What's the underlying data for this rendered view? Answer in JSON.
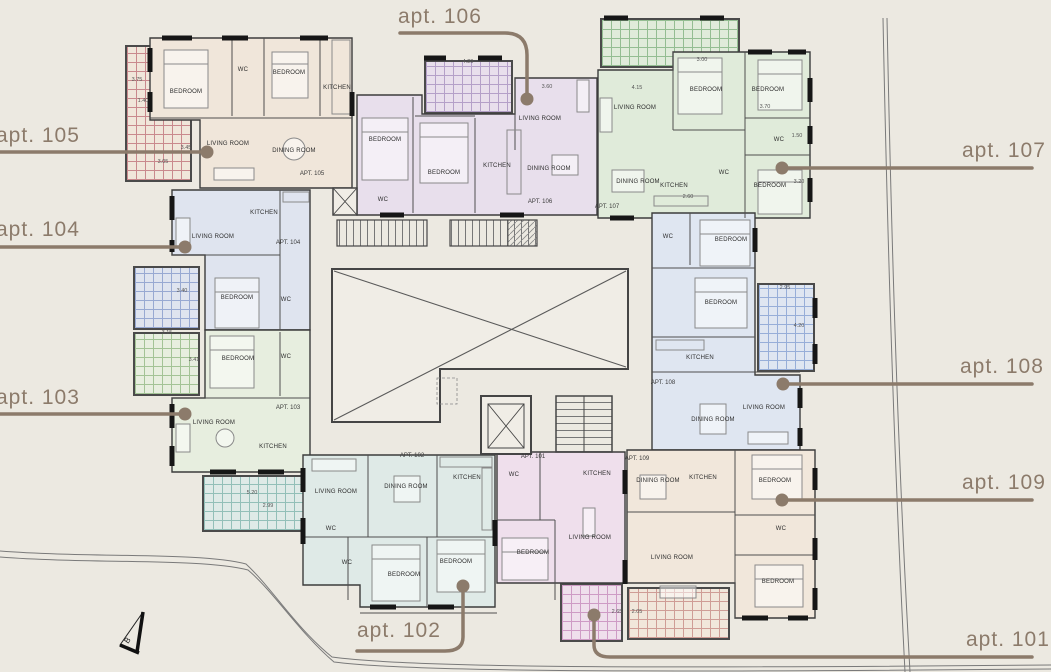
{
  "page_background": "#ECE9E1",
  "callout_color": "#8C7B6B",
  "apartments": [
    {
      "label": "apt. 105",
      "tag": "APT. 105",
      "fill": "#F0E6DA",
      "hatch": "#C9898D",
      "rooms": [
        "BEDROOM",
        "WC",
        "BEDROOM",
        "KITCHEN",
        "LIVING ROOM",
        "DINING ROOM"
      ]
    },
    {
      "label": "apt. 106",
      "tag": "APT. 106",
      "fill": "#E8DFEC",
      "hatch": "#B4A0C8",
      "rooms": [
        "BEDROOM",
        "BEDROOM",
        "KITCHEN",
        "LIVING ROOM",
        "DINING ROOM",
        "WC"
      ]
    },
    {
      "label": "apt. 107",
      "tag": "APT. 107",
      "fill": "#E0EBDA",
      "hatch": "#94BD92",
      "rooms": [
        "LIVING ROOM",
        "BEDROOM",
        "BEDROOM",
        "WC",
        "DINING ROOM",
        "KITCHEN",
        "BEDROOM",
        "WC"
      ]
    },
    {
      "label": "apt. 104",
      "tag": "APT. 104",
      "fill": "#DFE4EF",
      "hatch": "#98A9D2",
      "rooms": [
        "LIVING ROOM",
        "KITCHEN",
        "BEDROOM",
        "WC"
      ]
    },
    {
      "label": "apt. 103",
      "tag": "APT. 103",
      "fill": "#E7EEDF",
      "hatch": "#A3C396",
      "rooms": [
        "BEDROOM",
        "WC",
        "LIVING ROOM",
        "KITCHEN"
      ]
    },
    {
      "label": "apt. 108",
      "tag": "APT. 108",
      "fill": "#DFE6F1",
      "hatch": "#97AED8",
      "rooms": [
        "WC",
        "BEDROOM",
        "BEDROOM",
        "KITCHEN",
        "DINING ROOM",
        "LIVING ROOM"
      ]
    },
    {
      "label": "apt. 102",
      "tag": "APT. 102",
      "fill": "#DFEAE7",
      "hatch": "#93BFB8",
      "rooms": [
        "LIVING ROOM",
        "DINING ROOM",
        "KITCHEN",
        "WC",
        "WC",
        "BEDROOM",
        "BEDROOM"
      ]
    },
    {
      "label": "apt. 101",
      "tag": "APT. 101",
      "fill": "#EFDFEC",
      "hatch": "#CE9BC5",
      "rooms": [
        "WC",
        "KITCHEN",
        "LIVING ROOM",
        "BEDROOM"
      ]
    },
    {
      "label": "apt. 109",
      "tag": "APT. 109",
      "fill": "#F1E7DB",
      "hatch": "#CF9D96",
      "rooms": [
        "DINING ROOM",
        "KITCHEN",
        "LIVING ROOM",
        "BEDROOM",
        "WC",
        "BEDROOM"
      ]
    }
  ],
  "dimensions": [
    "3.75",
    "1.40",
    "3.05",
    "3.45",
    "4.20",
    "3.60",
    "3.00",
    "4.15",
    "3.70",
    "1.50",
    "3.20",
    "2.60",
    "3.40",
    "3.15",
    "3.41",
    "5.20",
    "2.99",
    "2.95",
    "4.20",
    "2.65",
    "2.05"
  ],
  "compass": {
    "letter": "B"
  }
}
